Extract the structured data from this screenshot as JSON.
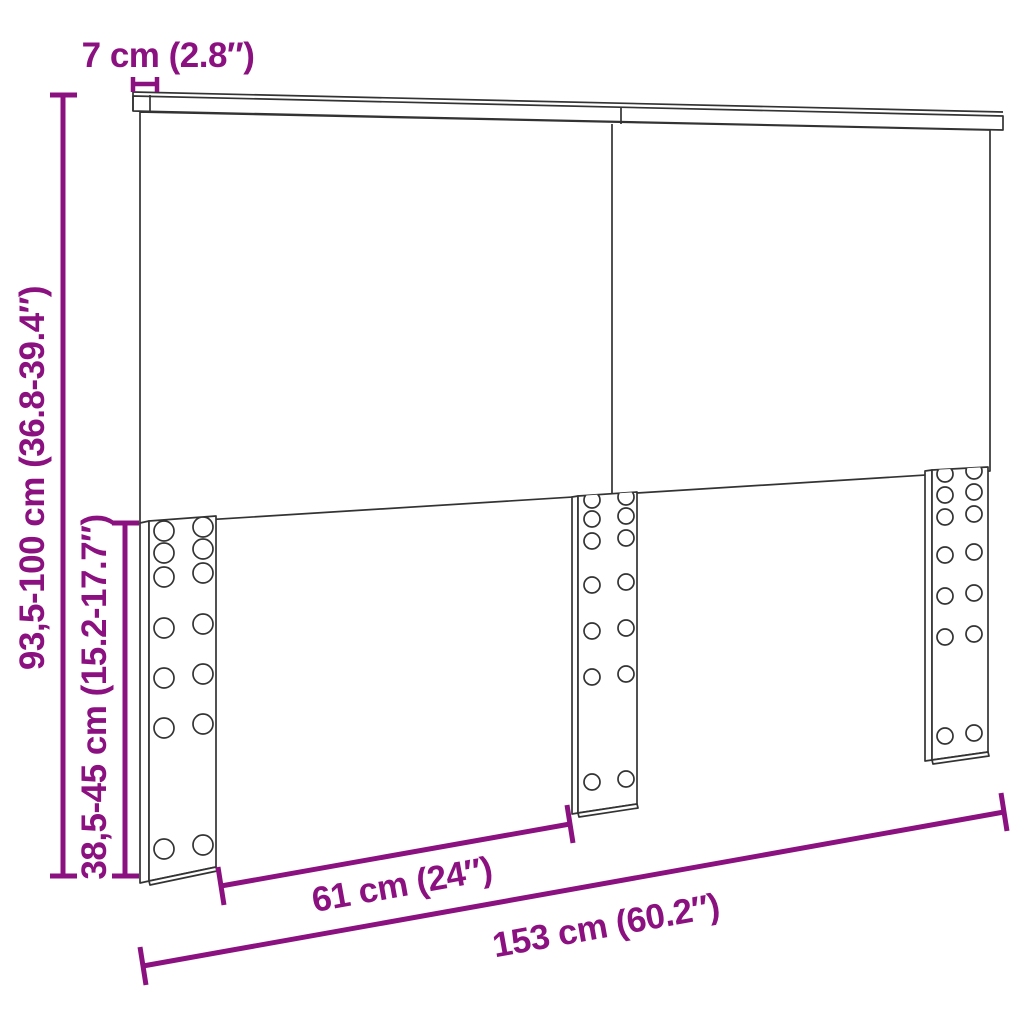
{
  "diagram": {
    "title": "headboard-dimension-diagram",
    "product": "headboard with three mounting legs",
    "colors": {
      "dimension_accent": "#8B1180",
      "outline": "#333333",
      "background": "#FFFFFF"
    },
    "labels": {
      "top_depth": "7 cm (2.8″)",
      "overall_height": "93,5-100 cm (36.8-39.4″)",
      "legs_height": "38,5-45 cm (15.2-17.7″)",
      "legs_gap_width": "61 cm (24″)",
      "overall_width": "153 cm (60.2″)"
    }
  }
}
